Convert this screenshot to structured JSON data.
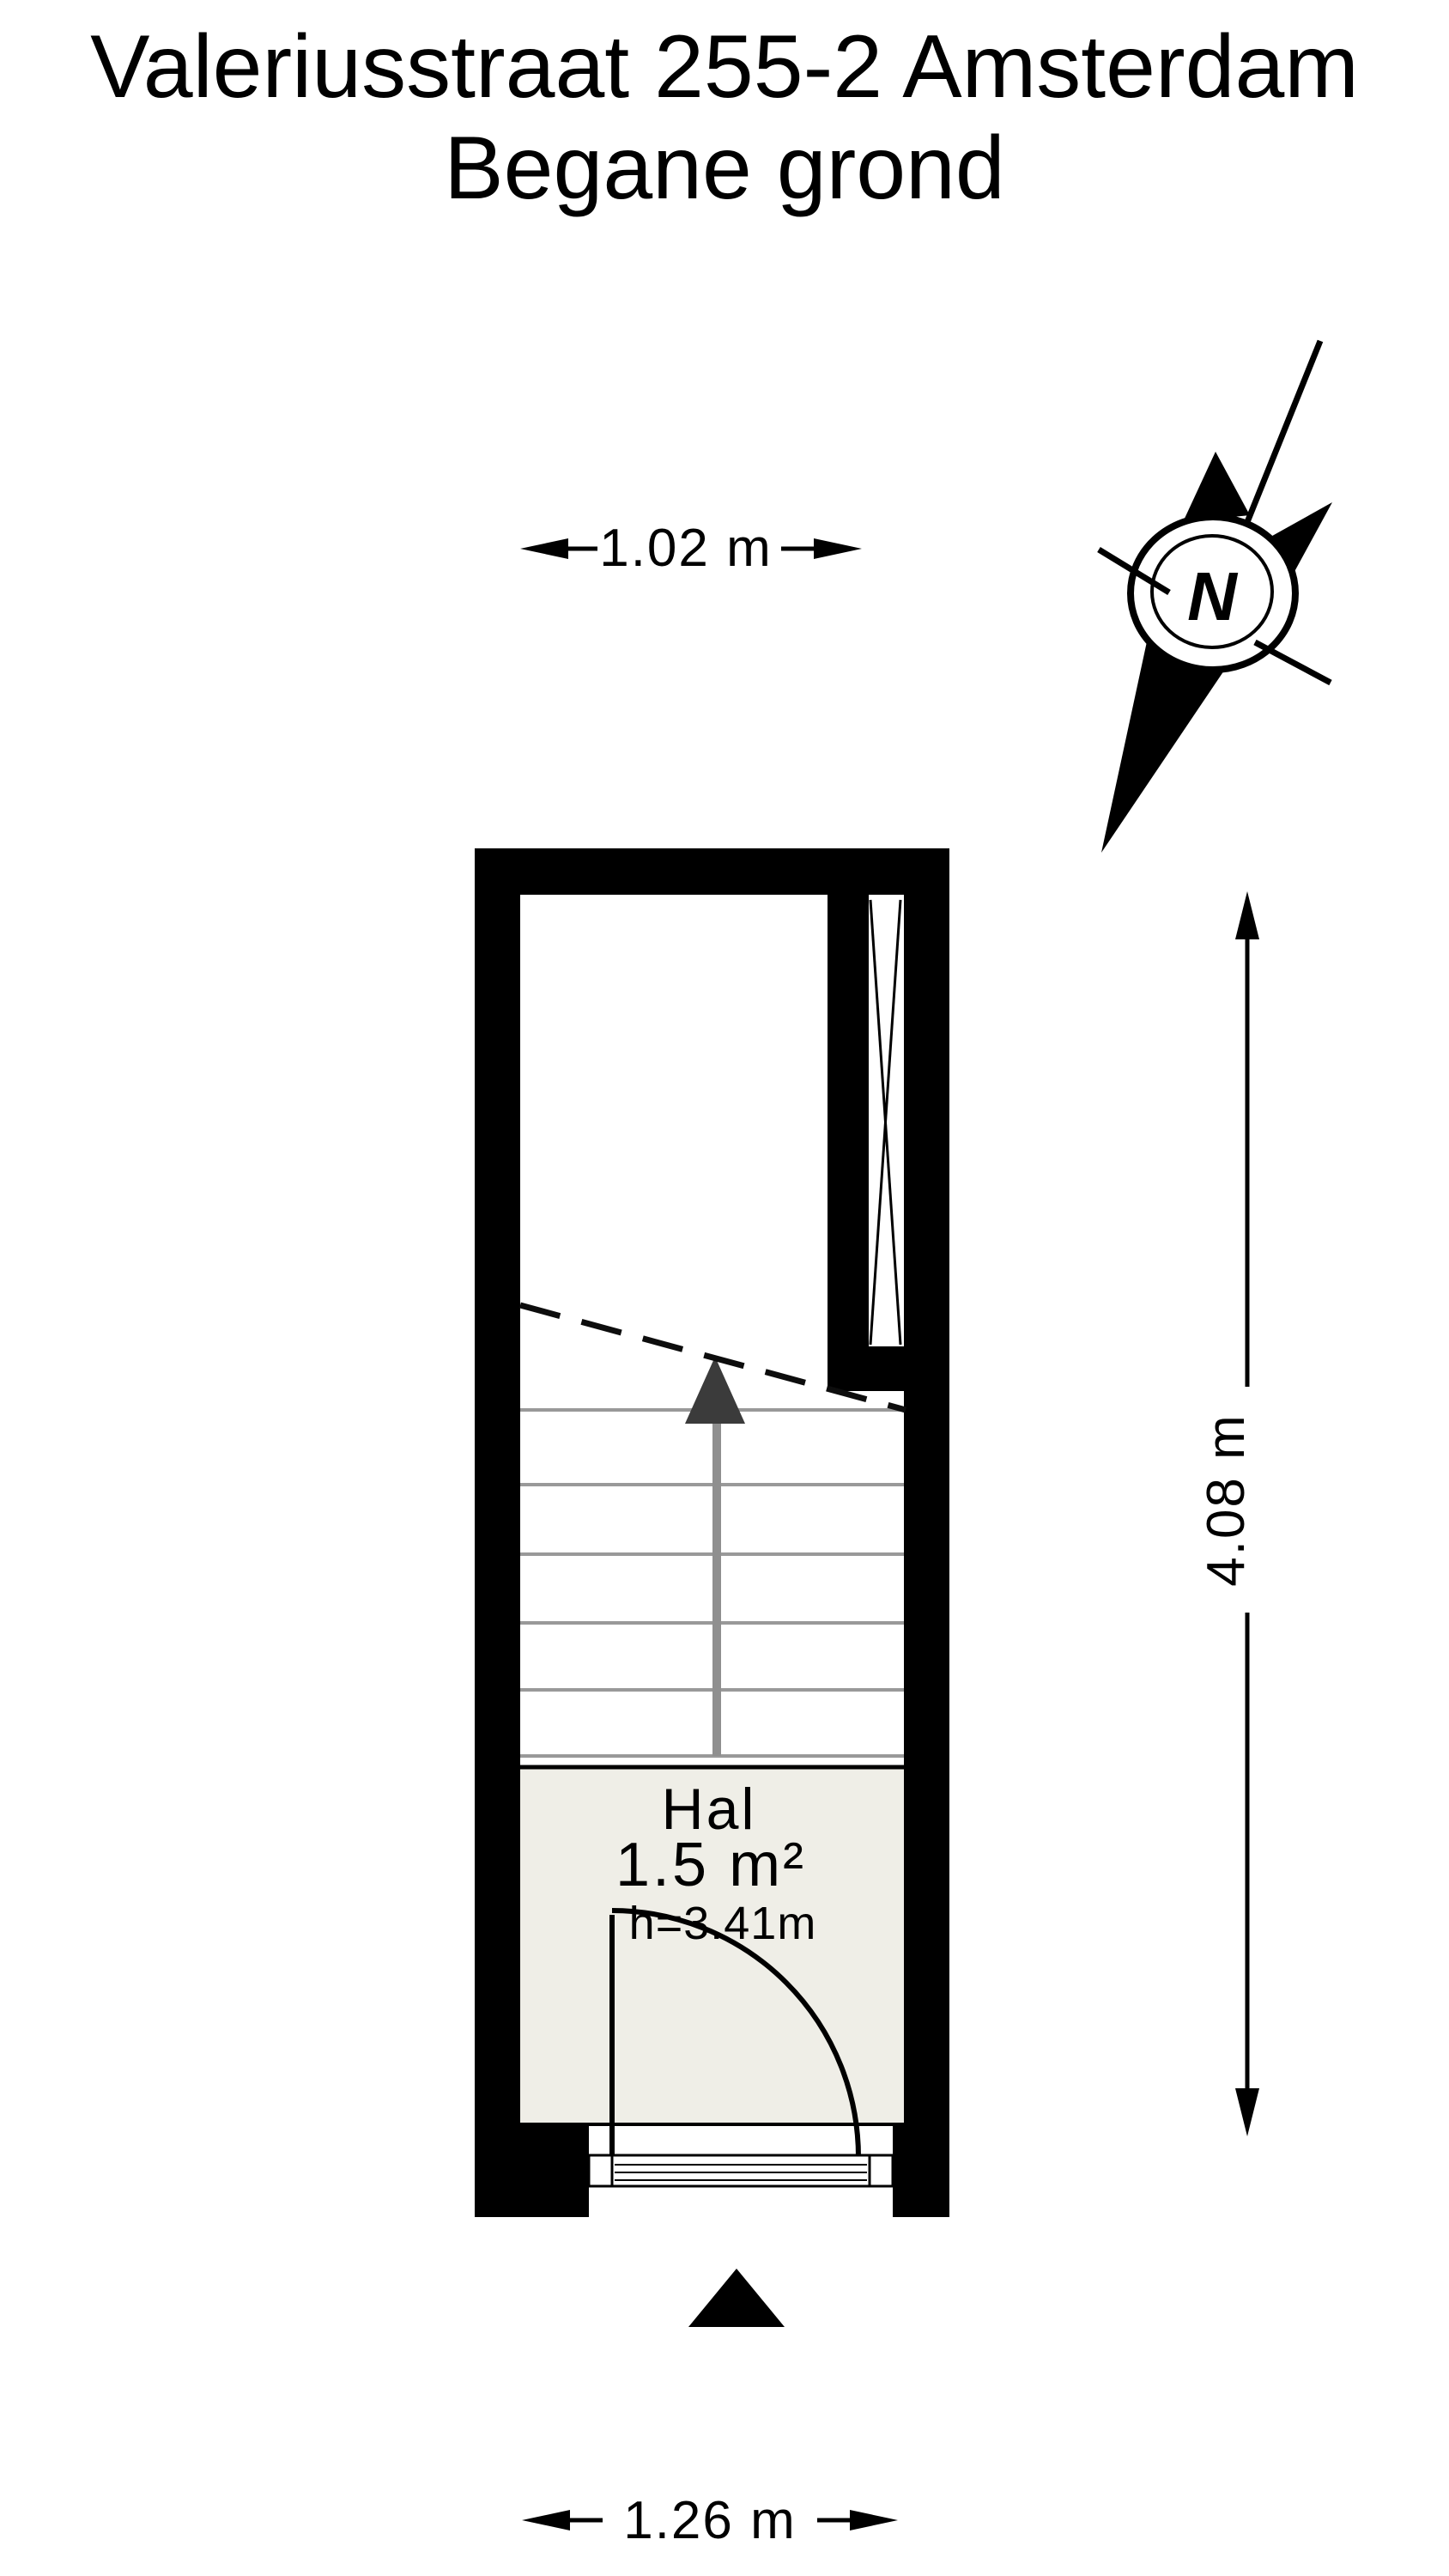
{
  "title": {
    "line1": "Valeriusstraat 255-2 Amsterdam",
    "line2": "Begane grond"
  },
  "floor_plan": {
    "room": {
      "name": "Hal",
      "area": "1.5 m²",
      "ceiling_height": "h=3.41m"
    },
    "dimensions": {
      "top_width": "1.02 m",
      "side_height": "4.08 m",
      "bottom_width": "1.26 m"
    },
    "compass": {
      "north_label": "N"
    }
  },
  "colors": {
    "wall": "#000000",
    "room_fill": "#efeee7",
    "stair_tread": "#999999",
    "stair_shaft": "#8f8f8f",
    "stair_arrow": "#3b3b3b",
    "background": "#ffffff"
  }
}
